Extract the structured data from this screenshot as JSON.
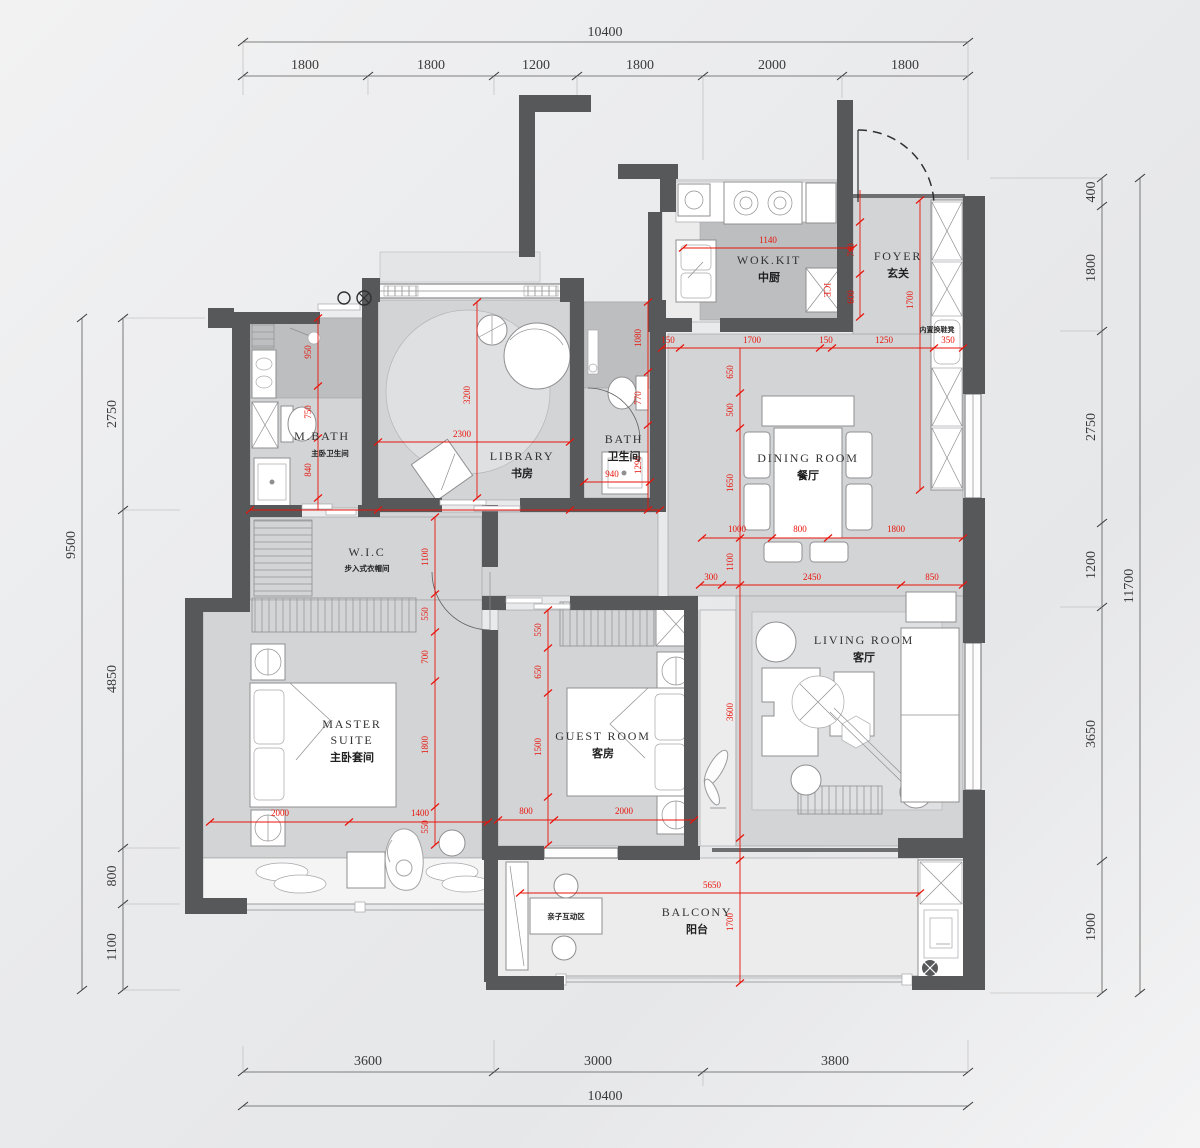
{
  "drawing": {
    "type": "apartment-floor-plan",
    "colors": {
      "wall": "#57585a",
      "floor": "#d3d4d6",
      "tile": "#bdbec0",
      "red_dim": "#e81309",
      "black_dim": "#3a3a3a"
    },
    "rooms": {
      "wok_kit": {
        "en": "WOK.KIT",
        "zh": "中厨"
      },
      "foyer": {
        "en": "FOYER",
        "zh": "玄关"
      },
      "dining": {
        "en": "DINING  ROOM",
        "zh": "餐厅"
      },
      "library": {
        "en": "LIBRARY",
        "zh": "书房"
      },
      "bath": {
        "en": "BATH",
        "zh": "卫生间"
      },
      "mbath": {
        "en": "M.BATH",
        "zh": "主卧卫生间"
      },
      "wic": {
        "en": "W.I.C",
        "zh": "步入式衣帽间"
      },
      "master": {
        "en1": "MASTER",
        "en2": "SUITE",
        "zh": "主卧套间"
      },
      "guest": {
        "en": "GUEST  ROOM",
        "zh": "客房"
      },
      "living": {
        "en": "LIVING  ROOM",
        "zh": "客厅"
      },
      "balcony": {
        "en": "BALCONY",
        "zh": "阳台"
      },
      "kids_zone": {
        "zh": "亲子互动区"
      }
    },
    "notes": {
      "shoe_bench": "内置换鞋凳",
      "fridge": "ICE"
    },
    "dims": {
      "top": {
        "total": "10400",
        "segments": [
          "1800",
          "1800",
          "1200",
          "1800",
          "2000",
          "1800"
        ]
      },
      "bottom": {
        "total": "10400",
        "segments": [
          "3600",
          "3000",
          "3800"
        ]
      },
      "right": {
        "total": "11700",
        "segments": [
          "400",
          "1800",
          "2750",
          "1200",
          "3650",
          "1900"
        ]
      },
      "left": {
        "total": "9500",
        "segments": [
          "2750",
          "4850",
          "800",
          "1100"
        ]
      },
      "red": {
        "kitchen_w": "1140",
        "kitchen_d1": "740",
        "kitchen_d2": "600",
        "foyer_h": "1700",
        "row_kitchen": [
          "150",
          "650",
          "1700",
          "150",
          "1250",
          "350"
        ],
        "dining_v": [
          "500",
          "1650"
        ],
        "row_dining": [
          "1000",
          "800",
          "1800"
        ],
        "hall_v": "1100",
        "row_living": [
          "300",
          "2450",
          "850"
        ],
        "living_v": "3600",
        "balcony_w": "5650",
        "balcony_d": "1700",
        "library_v": "3200",
        "library_w": "2300",
        "mbath_v": [
          "950",
          "750",
          "840"
        ],
        "bath_v": [
          "1080",
          "770",
          "1290"
        ],
        "bath_w": "940",
        "wic_v": [
          "1100",
          "550",
          "700"
        ],
        "master_v": "1800",
        "master_gap": "550",
        "row_master": [
          "2000",
          "1400"
        ],
        "guest_v": [
          "550",
          "650",
          "1500"
        ],
        "row_guest": [
          "800",
          "2000"
        ]
      }
    }
  }
}
